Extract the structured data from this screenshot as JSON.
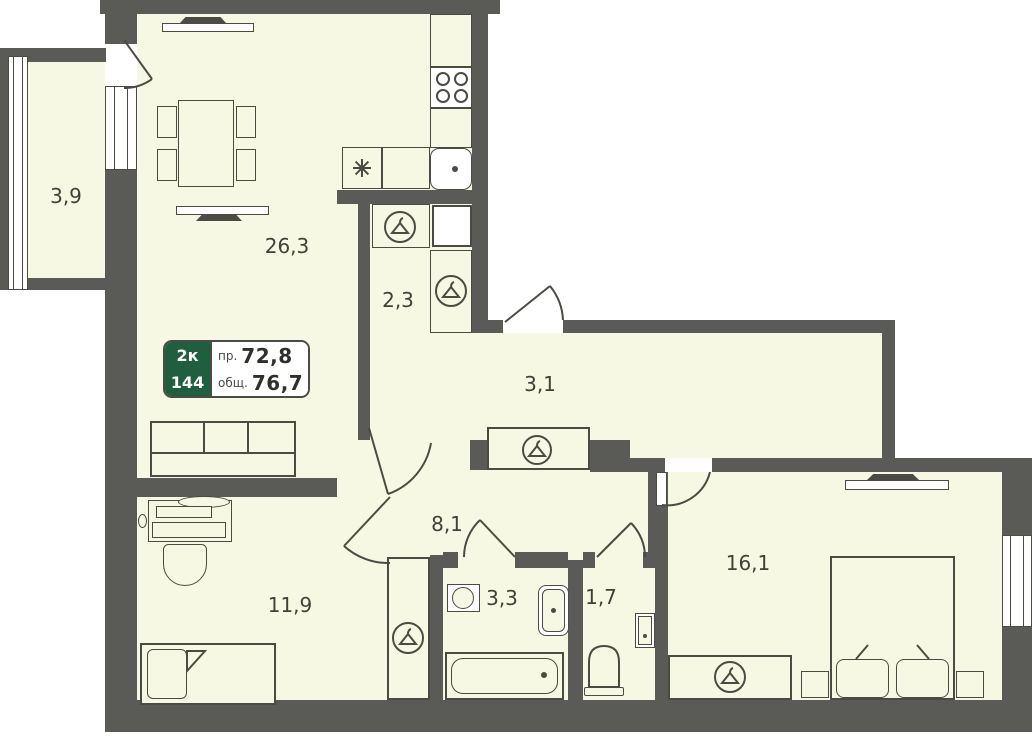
{
  "title": "2-room apartment floor plan",
  "rooms": {
    "balcony": "3,9",
    "living": "26,3",
    "hall_2_3": "2,3",
    "hall_3_1": "3,1",
    "hall_8_1": "8,1",
    "bedroom_small": "11,9",
    "bath": "3,3",
    "wc": "1,7",
    "bedroom": "16,1"
  },
  "info_box": {
    "type": "2к",
    "unit": "144",
    "rows": [
      {
        "label": "пр.",
        "value": "72,8"
      },
      {
        "label": "общ.",
        "value": "76,7"
      }
    ]
  },
  "icons": {
    "hanger": "clothes-hanger-in-circle",
    "star": "cooktop-asterisk",
    "burner": "stove-burner-circle"
  },
  "colors": {
    "wall": "#5a5a56",
    "floor": "#f6f8e3",
    "line": "#4b4b44",
    "green": "#1f5f3d",
    "background": "#ffffff"
  }
}
